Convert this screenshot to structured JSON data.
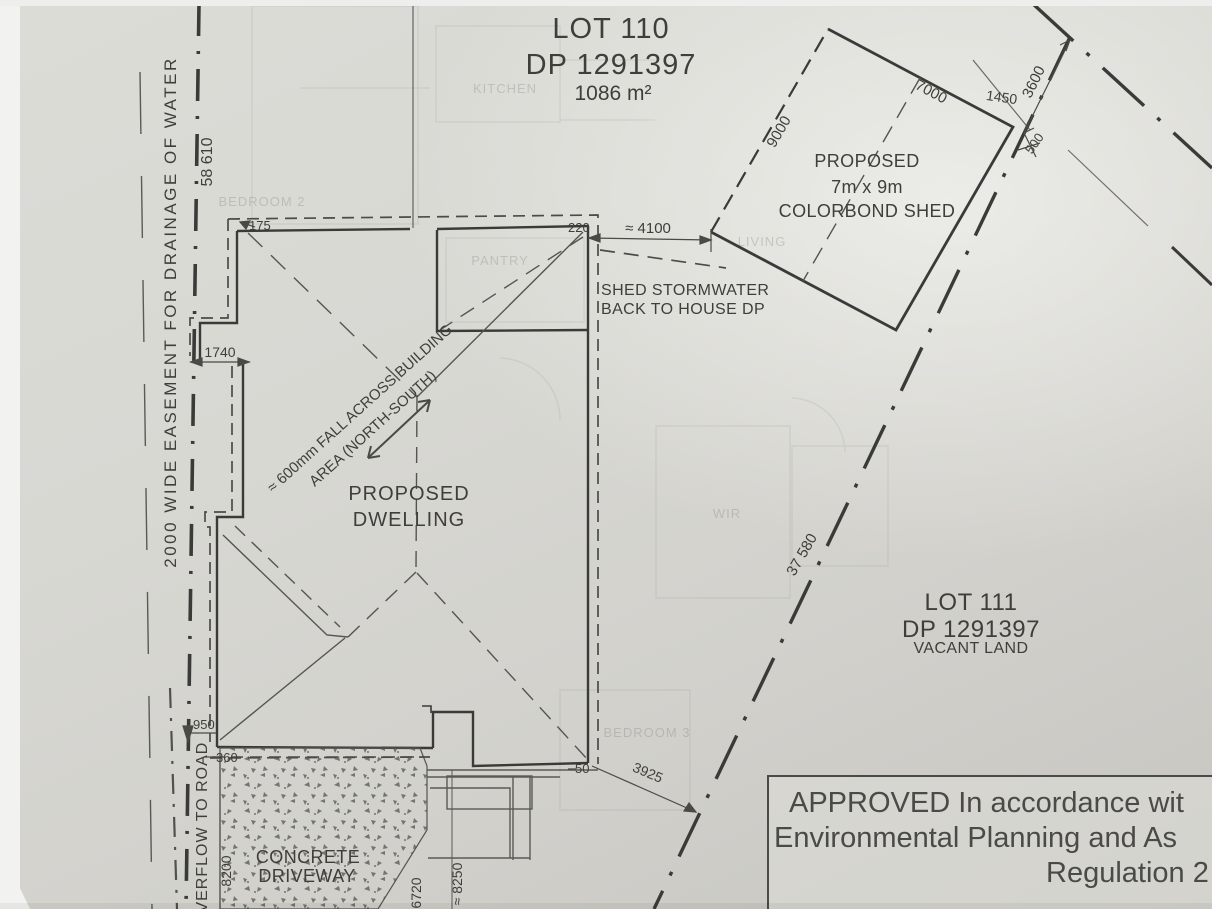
{
  "lot110": {
    "title": "LOT 110",
    "dp": "DP 1291397",
    "area": "1086 m²"
  },
  "lot111": {
    "title": "LOT 111",
    "dp": "DP 1291397",
    "note": "VACANT LAND"
  },
  "dwelling": {
    "line1": "PROPOSED",
    "line2": "DWELLING"
  },
  "shed": {
    "line1": "PROPOSED",
    "line2": "7m x 9m",
    "line3": "COLORBOND SHED"
  },
  "notes": {
    "stormwater1": "SHED STORMWATER",
    "stormwater2": "BACK TO HOUSE DP",
    "fall1": "≈ 600mm FALL ACROSS BUILDING",
    "fall2": "AREA (NORTH-SOUTH)",
    "easement": "2000 WIDE EASEMENT FOR DRAINAGE OF WATER",
    "overflow": "OVERFLOW TO ROAD",
    "driveway1": "CONCRETE",
    "driveway2": "DRIVEWAY"
  },
  "dims": {
    "west_boundary": "58 610",
    "east_boundary": "37 580",
    "offset_1740": "1740",
    "offset_175": "175",
    "offset_220": "220",
    "shed_to_house": "≈ 4100",
    "shed_width": "7000",
    "shed_length": "9000",
    "offset_1450": "1450",
    "offset_3600": "3600",
    "offset_500": "500",
    "offset_950": "950",
    "offset_360": "360",
    "drive_8200": "8200",
    "drive_6720": "6720",
    "drive_8250": "≈ 8250",
    "offset_50": "50",
    "offset_3925": "3925"
  },
  "stamp": {
    "line1": "APPROVED In accordance wit",
    "line2": "Environmental Planning and As",
    "line3": "Regulation 2"
  },
  "bleed": {
    "kitchen": "KITCHEN",
    "pantry": "PANTRY",
    "living": "LIVING",
    "wir": "WIR",
    "bedroom2": "BEDROOM 2",
    "bedroom3": "BEDROOM 3"
  },
  "colors": {
    "paper": "#d8d7d2",
    "ink": "#3a3a38",
    "ink_light": "#60605a",
    "stamp_ink": "#4a4a48"
  }
}
